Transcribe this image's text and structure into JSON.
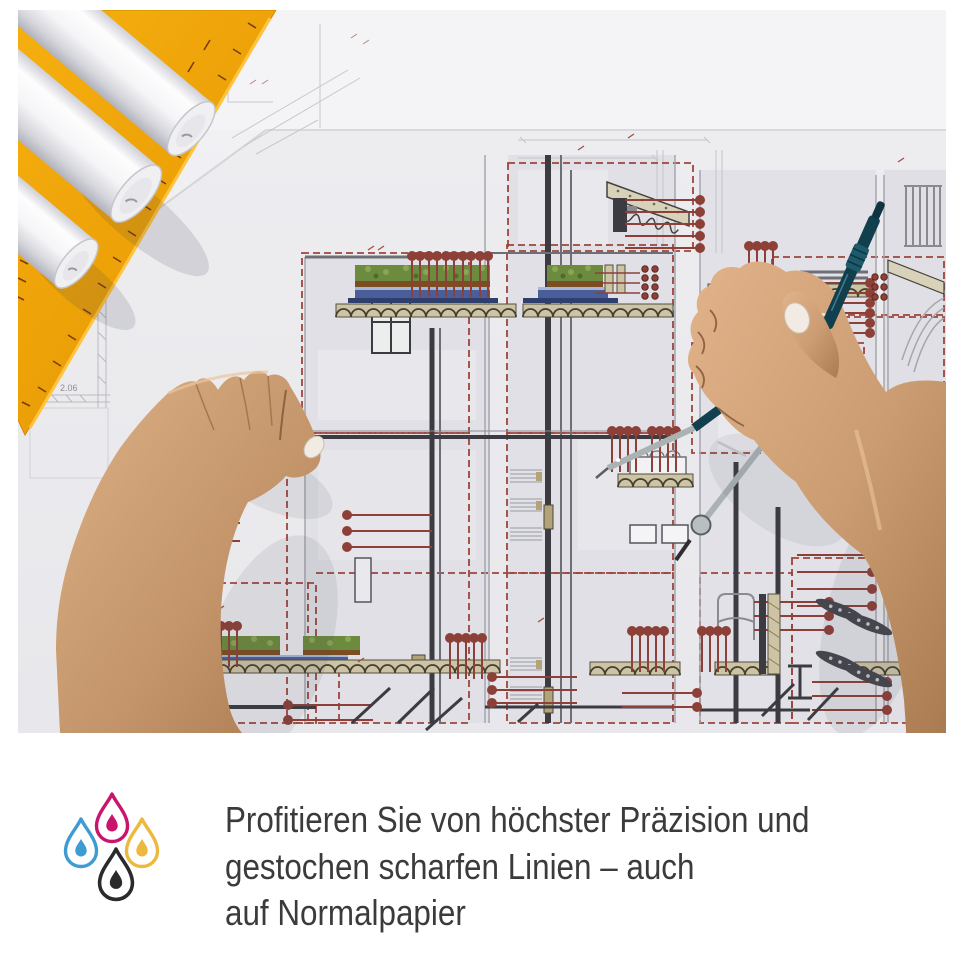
{
  "caption": {
    "line1": "Profitieren Sie von höchster Präzision und",
    "line2": "gestochen scharfen Linien – auch",
    "line3": "auf Normalpapier",
    "text_color": "#3b3b3b"
  },
  "ink_icon": {
    "label": "cmyk-ink-drops",
    "cyan": "#3E9CD3",
    "magenta": "#C9156B",
    "yellow": "#ECB93E",
    "black": "#2B2B2B"
  },
  "photo": {
    "description": "Architect's hands over a technical building-section blueprint: left hand holding a small white sheet, right hand using a divider compass; white paper rolls and an orange set square lie at the top left.",
    "blueprint_label": "2.06",
    "accents": {
      "callout_red": "#9C453B",
      "marker_red": "#8D4038",
      "set_square_orange": "#F3A606",
      "vegetation_green": "#6D8B3E",
      "insulation_blue": "#4A5F9A",
      "deck_tan": "#CDC4A5",
      "compass_teal": "#123F4D"
    }
  }
}
